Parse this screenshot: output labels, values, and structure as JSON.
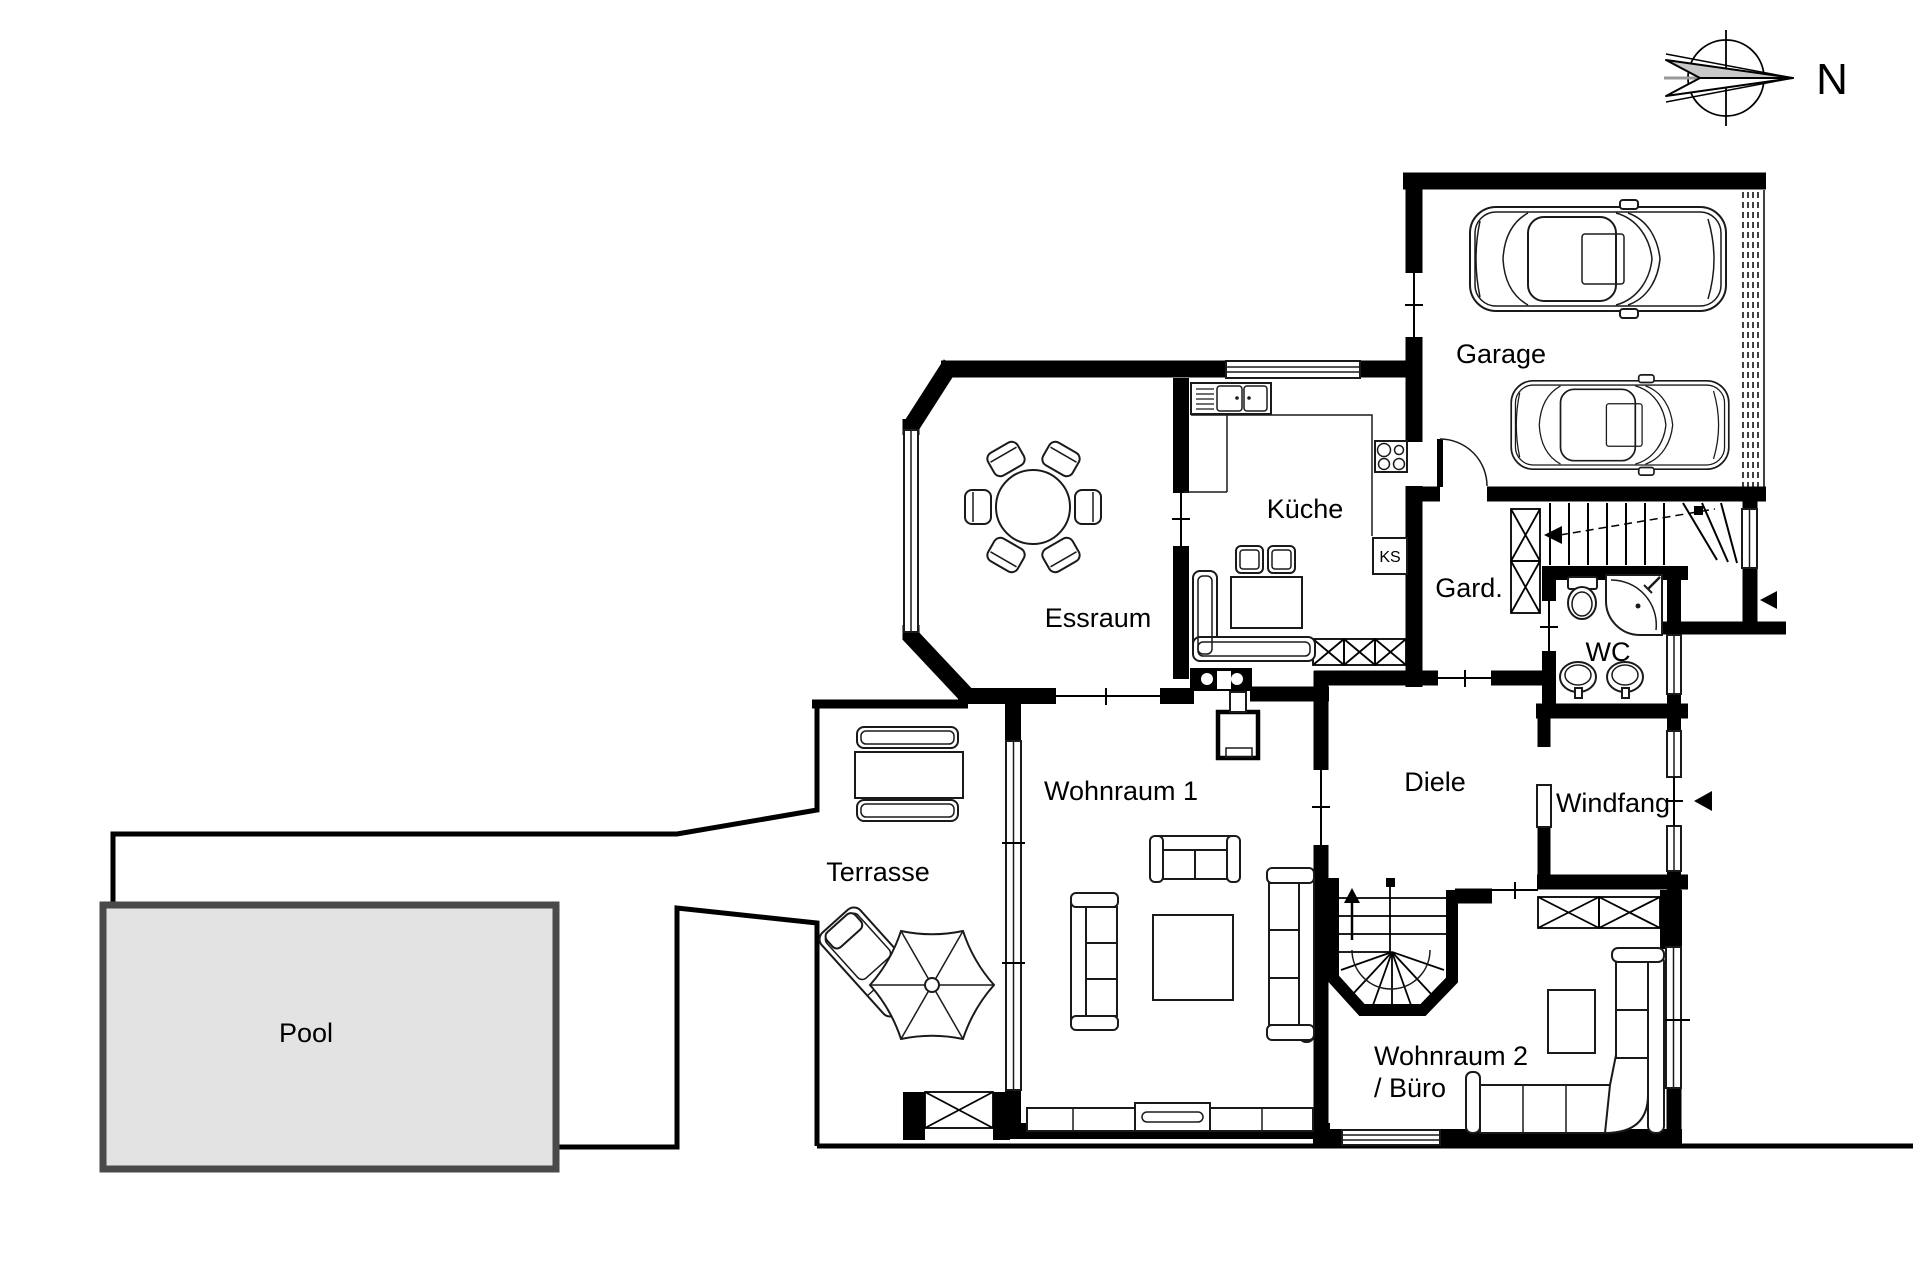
{
  "plan": {
    "title": "floor-plan-ground-floor",
    "labels": {
      "garage": "Garage",
      "kueche": "Küche",
      "ks": "KS",
      "garderobe": "Gard.",
      "wc": "WC",
      "essraum": "Essraum",
      "diele": "Diele",
      "windfang": "Windfang",
      "wohnraum1": "Wohnraum 1",
      "wohnraum2_line1": "Wohnraum 2",
      "wohnraum2_line2": "/ Büro",
      "terrasse": "Terrasse",
      "pool": "Pool",
      "compass_north": "N"
    },
    "colors": {
      "wall": "#000000",
      "pool_fill": "#e3e3e3",
      "pool_border": "#4a4a4a",
      "compass_gray": "#c8c8c8",
      "background": "#ffffff"
    },
    "icons": {
      "compass": "compass-rose-icon",
      "cars": "car-top-view-icon",
      "entrance_arrows": "entrance-arrow-icon"
    }
  }
}
